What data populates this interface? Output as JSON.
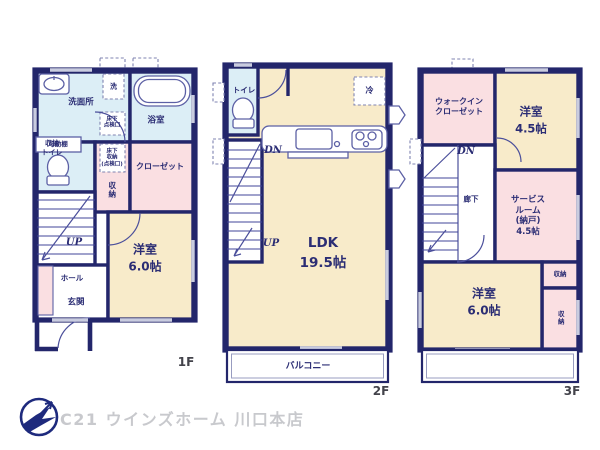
{
  "page": {
    "background": "#ffffff"
  },
  "branding": {
    "logo_text": "C21 ウインズホーム 川口本店"
  },
  "colors": {
    "wall": "#23266b",
    "room_cream": "#f8ebca",
    "room_pink": "#fadfe2",
    "room_blue": "#dceef6",
    "window": "#c9ccdf",
    "label": "#2b2d74",
    "logo_text": "#c8c9cd",
    "logo_mark": "#1e2a7d"
  },
  "floor1": {
    "floor_label": "1F",
    "washroom": "洗面所",
    "washer": "洗",
    "bathroom": "浴室",
    "movable_shelf": "可動棚",
    "underfloor_hatch": "床下\n点検口",
    "underfloor_storage": "床下\n収納\n(点検口)",
    "toilet": "収納\nトイレ",
    "storage_vertical": "収納",
    "closet": "クローゼット",
    "stairs_up": "UP",
    "hall": "ホール",
    "entrance": "玄関",
    "bedroom": "洋室\n6.0帖"
  },
  "floor2": {
    "floor_label": "2F",
    "toilet": "トイレ",
    "refrigerator": "冷",
    "stairs_down": "DN",
    "stairs_up": "UP",
    "ldk": "LDK\n19.5帖",
    "balcony": "バルコニー"
  },
  "floor3": {
    "floor_label": "3F",
    "walk_in_closet": "ウォークイン\nクローゼット",
    "bedroom_small": "洋室\n4.5帖",
    "stairs_down": "DN",
    "corridor": "廊下",
    "service_room": "サービス\nルーム\n(納戸)\n4.5帖",
    "storage_a": "収納",
    "storage_b": "収納",
    "bedroom_large": "洋室\n6.0帖"
  }
}
